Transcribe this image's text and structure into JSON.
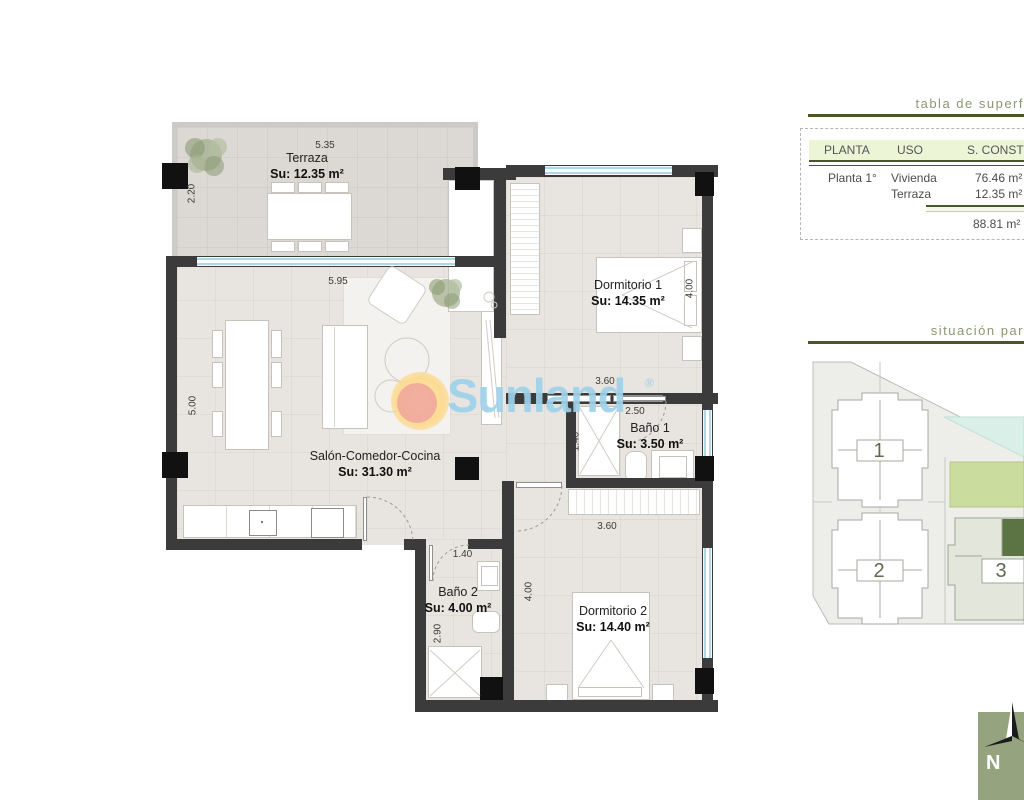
{
  "colors": {
    "wall": "#3b3b3b",
    "pillar": "#111111",
    "floor": "#e8e4df",
    "terrace_floor": "#dcd8d3",
    "window": "#aadbe4",
    "olive": "#49552c",
    "title_green": "#8b9770",
    "header_bg": "#edf5d7",
    "pool": "#d9efe8",
    "garden": "#cadc9e",
    "unit_highlight": "#5c7444",
    "compass_bg": "#95a37e",
    "sun_yellow": "#fcda8e",
    "sun_pink": "#f0a49c",
    "brand_blue": "#9fd2ea"
  },
  "floorplan": {
    "rooms": {
      "terraza": {
        "name": "Terraza",
        "area": "Su: 12.35 m²"
      },
      "salon": {
        "name": "Salón-Comedor-Cocina",
        "area": "Su: 31.30 m²"
      },
      "dormitorio1": {
        "name": "Dormitorio 1",
        "area": "Su: 14.35 m²"
      },
      "bano1": {
        "name": "Baño 1",
        "area": "Su: 3.50 m²"
      },
      "bano2": {
        "name": "Baño 2",
        "area": "Su: 4.00 m²"
      },
      "dormitorio2": {
        "name": "Dormitorio 2",
        "area": "Su: 14.40 m²"
      }
    },
    "dims": {
      "terraza_width": "5.35",
      "terraza_depth": "2.20",
      "salon_width": "5.95",
      "salon_depth": "5.00",
      "dorm1_width": "3.60",
      "dorm1_depth": "4.00",
      "bano1_width": "2.50",
      "bano1_depth": "1.40",
      "bano2_width": "1.40",
      "bano2_depth": "2.90",
      "dorm2_width": "3.60",
      "dorm2_depth": "4.00"
    }
  },
  "watermark": {
    "brand": "Sunland",
    "registered": "®"
  },
  "surface_table": {
    "title": "tabla de superf",
    "columns": [
      "PLANTA",
      "USO",
      "S. CONST"
    ],
    "rows": [
      {
        "planta": "Planta 1°",
        "uso": "Vivienda",
        "superficie": "76.46 m²"
      },
      {
        "planta": "",
        "uso": "Terraza",
        "superficie": "12.35 m²"
      }
    ],
    "total": "88.81 m²"
  },
  "site_plan": {
    "title": "situación par",
    "buildings": [
      {
        "label": "1"
      },
      {
        "label": "2"
      },
      {
        "label": "3"
      }
    ]
  },
  "compass": {
    "north_label": "N"
  }
}
